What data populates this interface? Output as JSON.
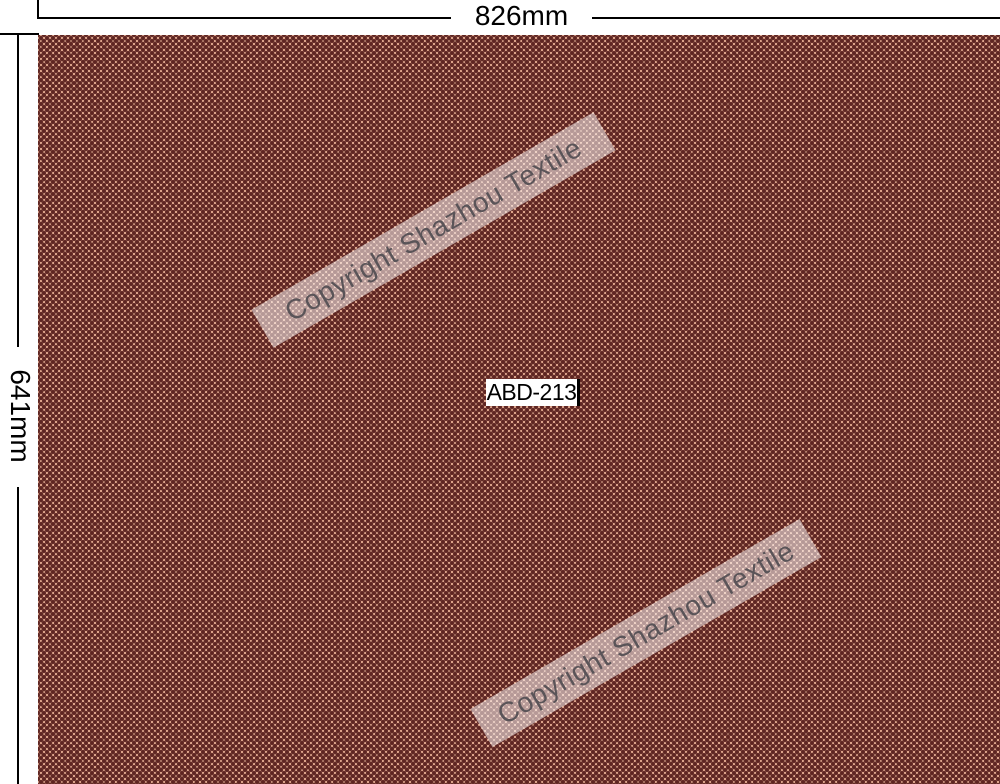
{
  "annotations": {
    "width_label": "826mm",
    "height_label": "641mm"
  },
  "swatch": {
    "product_code": "ABD-213",
    "watermark_text": "Copyright Shazhou Textile"
  },
  "colors": {
    "fabric_dark": "#5E2522",
    "fabric_ground": "#F0B79B",
    "dimension_line": "#000000",
    "label_background": "#FFFFFF",
    "label_text": "#000000",
    "watermark_band": "rgba(255,250,250,0.54)",
    "watermark_text": "#5A5458"
  }
}
